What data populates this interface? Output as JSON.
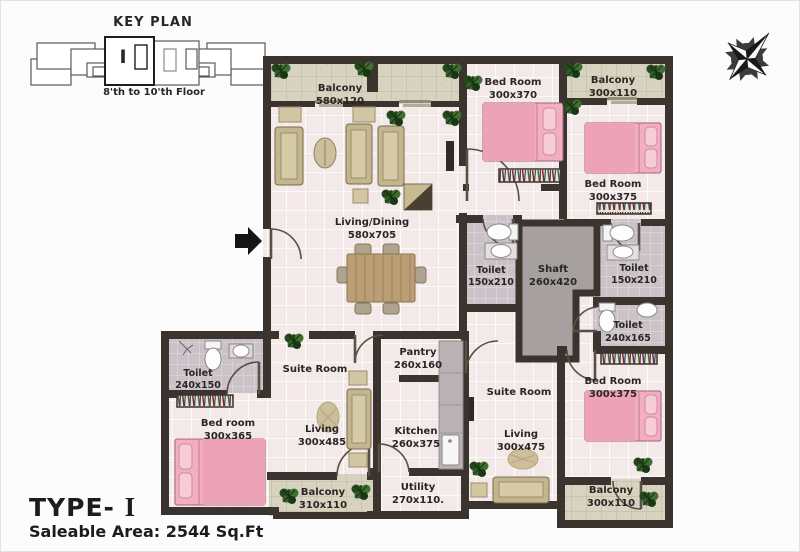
{
  "key_plan": {
    "title": "KEY PLAN",
    "floors": "8'th  to  10'th Floor",
    "unit_mark": "I"
  },
  "compass": {
    "icon": "compass-rose"
  },
  "rooms": {
    "balcony_top": {
      "name": "Balcony",
      "dims": "580x120"
    },
    "bedroom_top": {
      "name": "Bed Room",
      "dims": "300x370"
    },
    "balcony_top_right": {
      "name": "Balcony",
      "dims": "300x110"
    },
    "bedroom_right": {
      "name": "Bed Room",
      "dims": "300x375"
    },
    "living_dining": {
      "name": "Living/Dining",
      "dims": "580x705"
    },
    "toilet_mid_left": {
      "name": "Toilet",
      "dims": "150x210"
    },
    "shaft": {
      "name": "Shaft",
      "dims": "260x420"
    },
    "toilet_mid_right": {
      "name": "Toilet",
      "dims": "150x210"
    },
    "toilet_right_lower": {
      "name": "Toilet",
      "dims": "240x165"
    },
    "suite_left": {
      "name": "Suite Room"
    },
    "toilet_bottom_left": {
      "name": "Toilet",
      "dims": "240x150"
    },
    "bedroom_bottom_left": {
      "name": "Bed room",
      "dims": "300x365"
    },
    "living_left": {
      "name": "Living",
      "dims": "300x485"
    },
    "pantry": {
      "name": "Pantry",
      "dims": "260x160"
    },
    "kitchen": {
      "name": "Kitchen",
      "dims": "260x375"
    },
    "suite_right": {
      "name": "Suite Room"
    },
    "living_right": {
      "name": "Living",
      "dims": "300x475"
    },
    "bedroom_bottom_right": {
      "name": "Bed Room",
      "dims": "300x375"
    },
    "balcony_bottom_left": {
      "name": "Balcony",
      "dims": "310x110"
    },
    "utility": {
      "name": "Utility",
      "dims": "270x110."
    },
    "balcony_bottom_right": {
      "name": "Balcony",
      "dims": "300x110"
    }
  },
  "footer": {
    "type_prefix": "TYPE- ",
    "type_roman": "I",
    "area": "Saleable Area: 2544 Sq.Ft"
  },
  "palette": {
    "wall": "#3b332d",
    "floor_main": "#f2e9e8",
    "floor_balcony": "#d7d3c0",
    "floor_toilet": "#cbc2c7",
    "shaft": "#a7a0a1",
    "bed_pink": "#f2afc1",
    "sofa_beige": "#c3b68c",
    "wood": "#bb9d76",
    "plant_green": "#2e5526",
    "text": "#2a2624"
  }
}
